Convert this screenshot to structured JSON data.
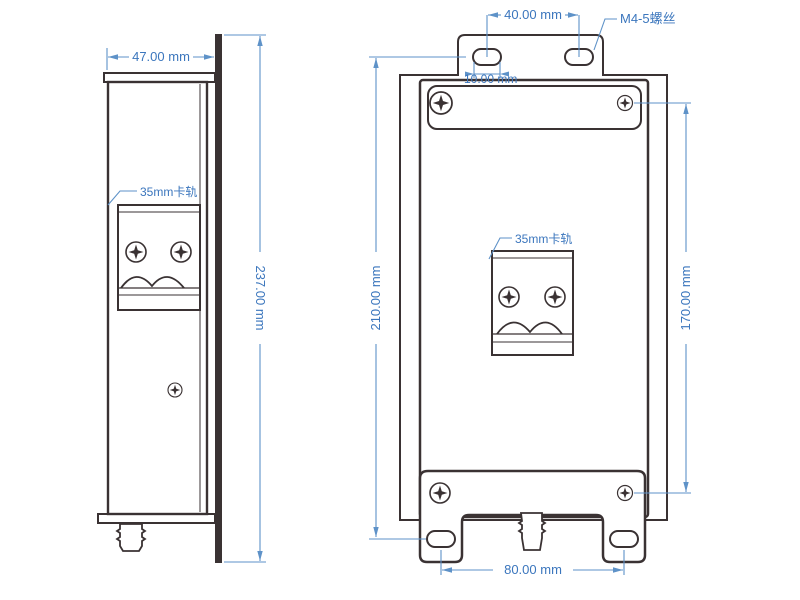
{
  "drawing": {
    "side_view": {
      "width_dim": "47.00 mm",
      "height_dim": "237.00 mm",
      "din_rail_label": "35mm卡轨"
    },
    "front_view": {
      "top_hole_spacing_dim": "40.00 mm",
      "slot_width_dim": "10.00 mm",
      "screw_label": "M4-5螺丝",
      "left_height_dim": "210.00 mm",
      "right_height_dim": "170.00 mm",
      "bottom_hole_spacing_dim": "80.00 mm",
      "din_rail_label": "35mm卡轨"
    },
    "colors": {
      "outline": "#3a3233",
      "dimension_line": "#5e92c8",
      "dimension_text": "#3b76bd"
    }
  }
}
